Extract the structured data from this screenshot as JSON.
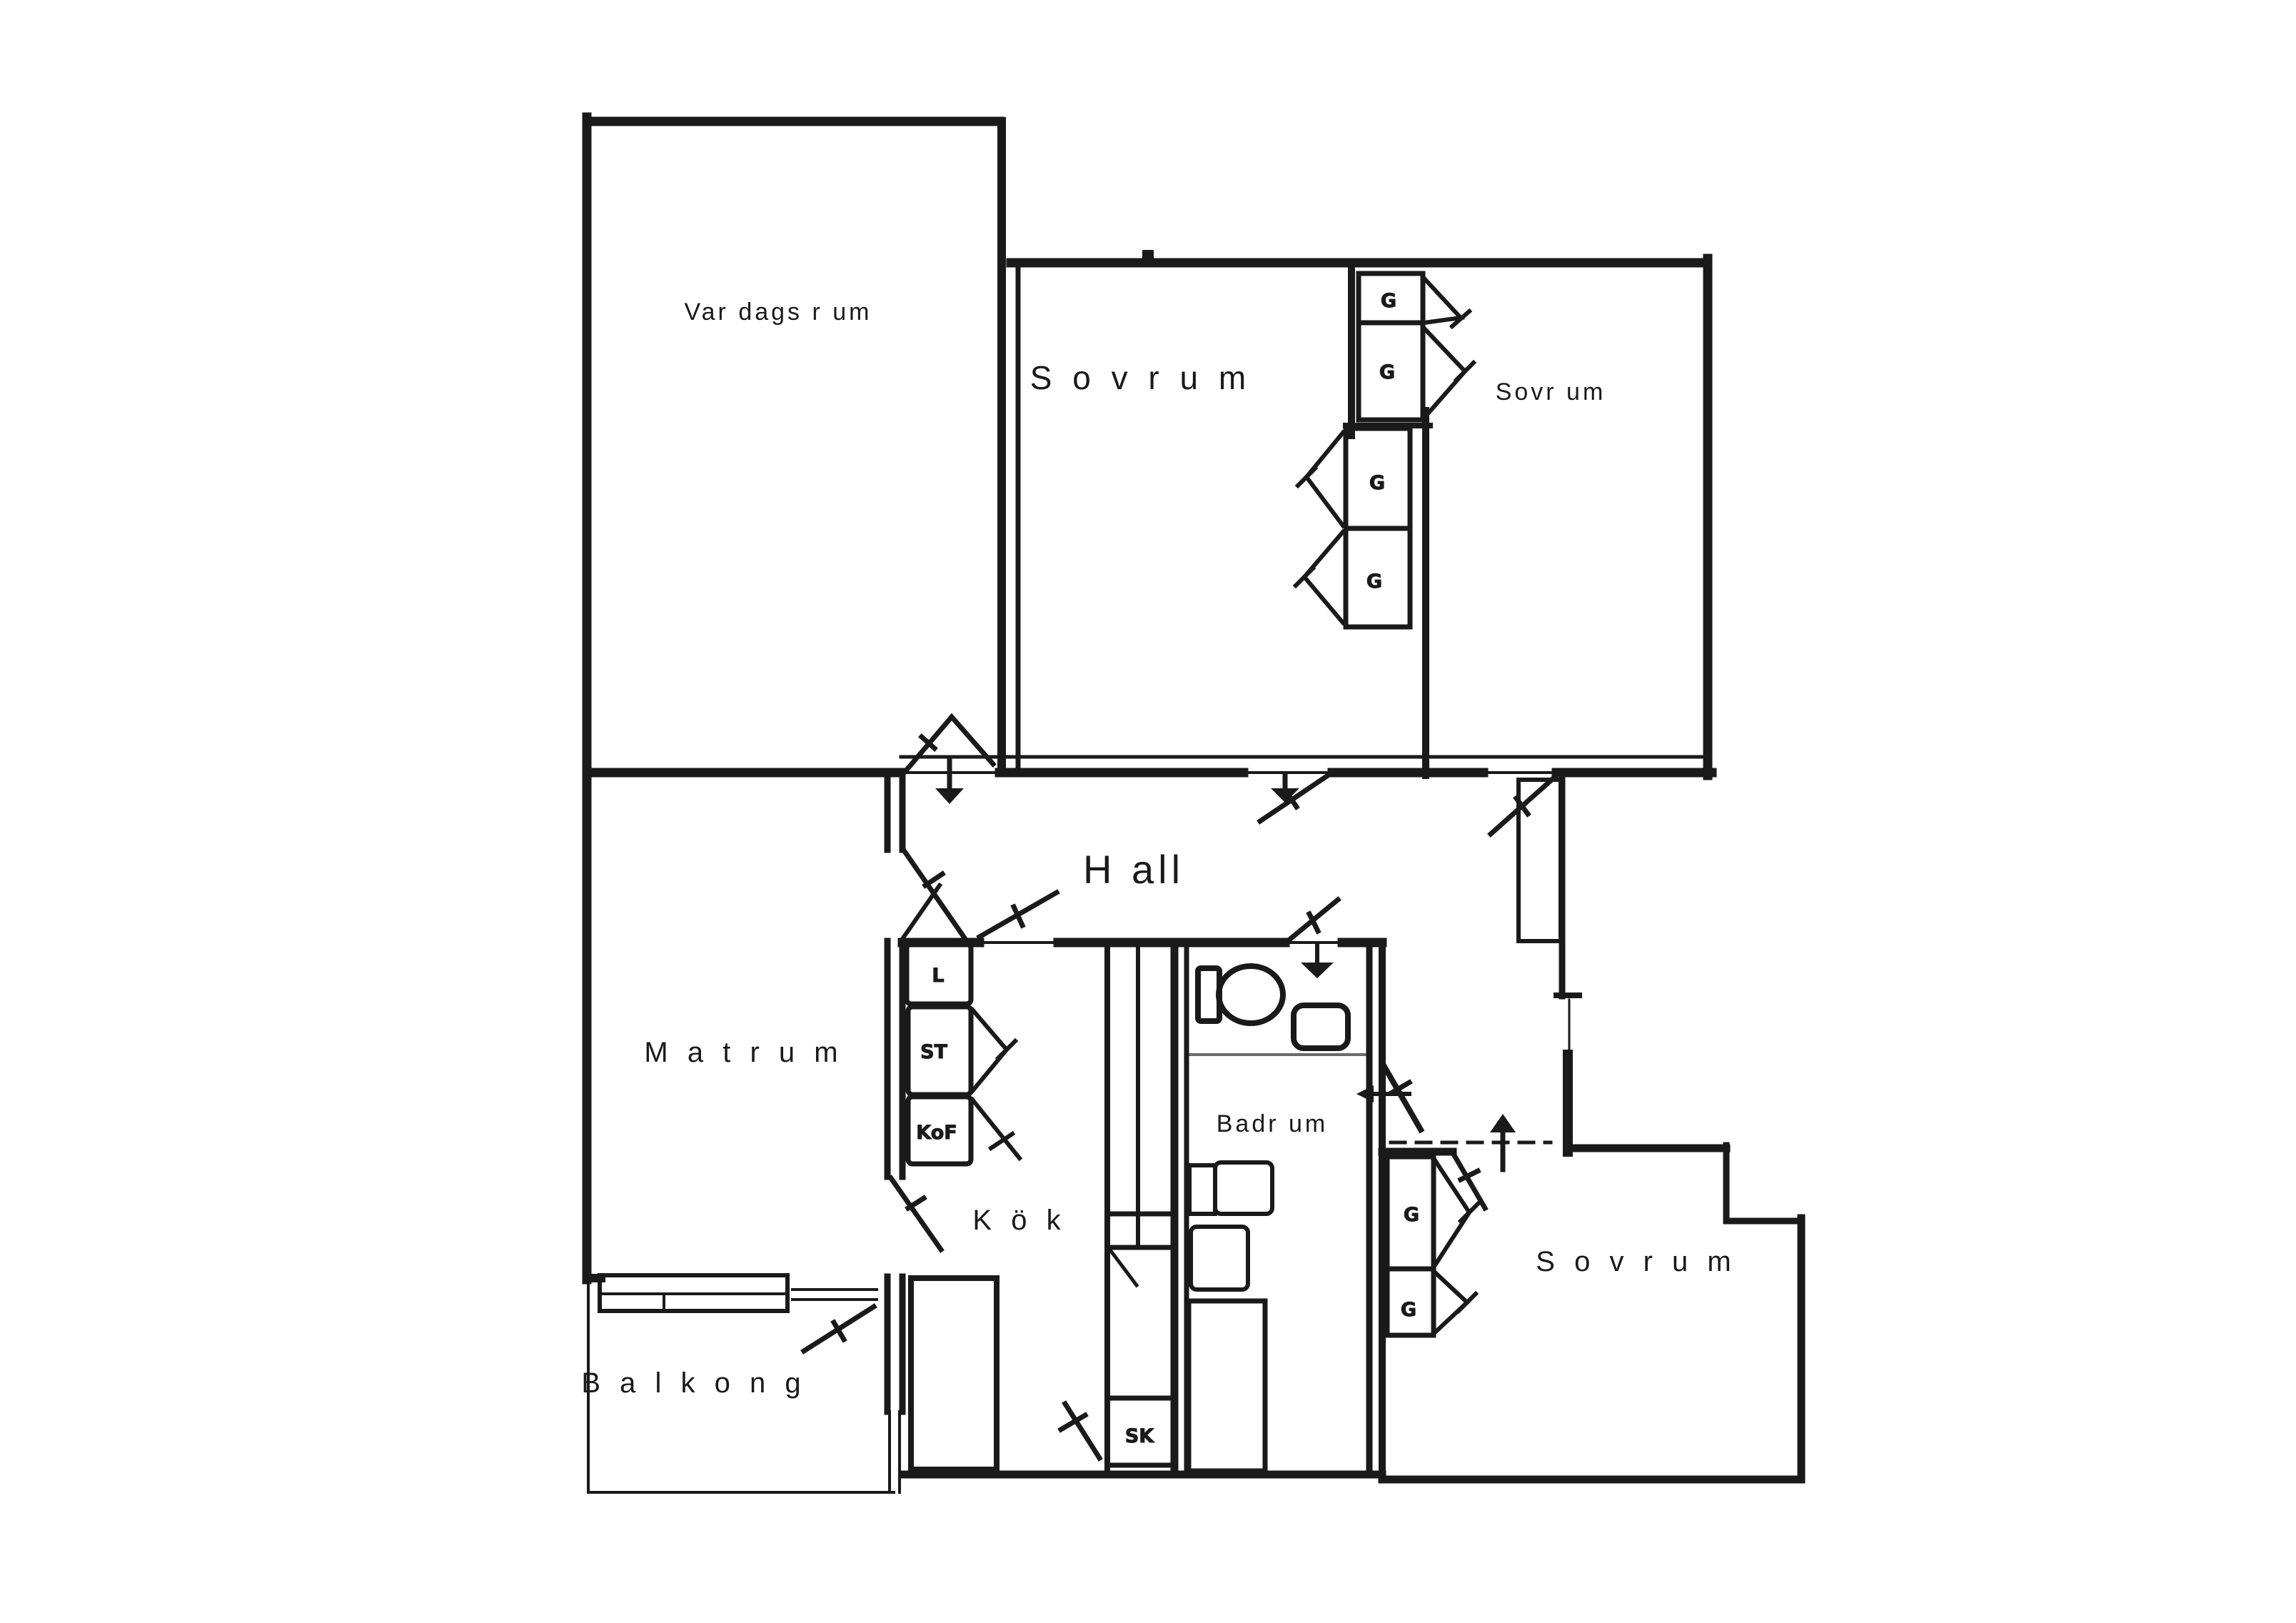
{
  "floor_plan": {
    "type": "apartment-floor-plan",
    "rooms": {
      "vardagsrum": {
        "label": "Var dags r um"
      },
      "sovrum_top": {
        "label": "S o v r u m"
      },
      "sovrum_right": {
        "label": "Sovr um"
      },
      "hall": {
        "label": "H all"
      },
      "matrum": {
        "label": "M a t r u m"
      },
      "kok": {
        "label": "K ö k"
      },
      "badrum": {
        "label": "Badr um"
      },
      "balkong": {
        "label": "B a l k o n g"
      },
      "sovrum_bottom": {
        "label": "S o v r u m"
      }
    },
    "closets": {
      "top_column": [
        "G",
        "G",
        "G",
        "G"
      ],
      "bedroom_bottom": [
        "G",
        "G"
      ],
      "kitchen": {
        "l": "L",
        "st": "ST",
        "kof": "KoF",
        "sk": "SK"
      }
    },
    "colors": {
      "ink": "#1a1a1a",
      "paper": "#ffffff"
    }
  }
}
